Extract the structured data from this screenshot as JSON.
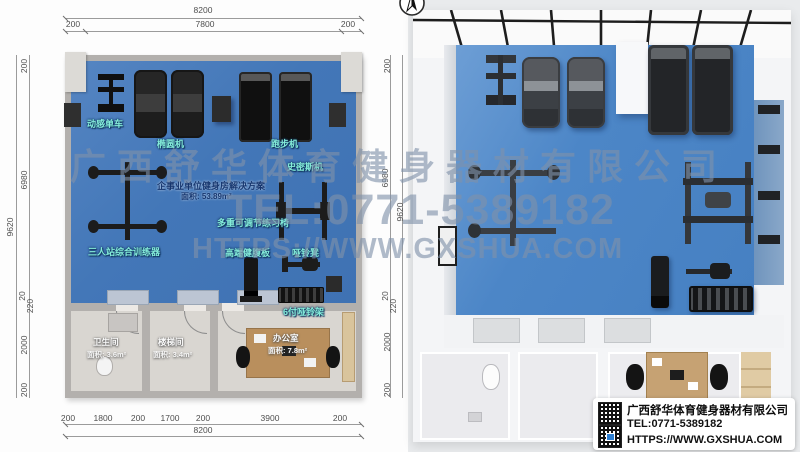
{
  "watermark": {
    "company": "广西舒华体育健身器材有限公司",
    "tel": "TEL:0771-5389182",
    "url": "HTTPS://WWW.GXSHUA.COM"
  },
  "plan": {
    "title": "企事业单位健身房解决方案",
    "area": "面积: 53.89m²",
    "dims": {
      "top_total": "8200",
      "top_row": [
        "200",
        "7800",
        "200"
      ],
      "left_total": "9620",
      "left_col": [
        "200",
        "6980",
        "20",
        "220",
        "2000",
        "200"
      ],
      "bottom_row": [
        "200",
        "1800",
        "200",
        "1700",
        "200",
        "3900",
        "200"
      ],
      "bottom_total": "8200"
    },
    "labels": {
      "spin_bike": "动感单车",
      "elliptical": "椭圆机",
      "treadmill": "跑步机",
      "smith": "史密斯机",
      "adjustable_bench": "多重可调节练习椅",
      "multi_trainer": "三人站综合训练器",
      "ab_board": "高端健腹板",
      "dumbbell_bench": "哑铃凳",
      "dumbbell_rack": "6付哑铃架"
    },
    "rooms": {
      "toilet": {
        "name": "卫生间",
        "area": "面积: 3.6m²"
      },
      "stairs": {
        "name": "楼梯间",
        "area": "面积: 3.4m²"
      },
      "office": {
        "name": "办公室",
        "area": "面积: 7.8m²"
      }
    }
  },
  "render": {
    "dims": {
      "total": "9620",
      "col": [
        "200",
        "6980",
        "20",
        "220",
        "2000",
        "200"
      ]
    }
  },
  "info_card": {
    "company": "广西舒华体育健身器材有限公司",
    "tel": "TEL:0771-5389182",
    "url": "HTTPS://WWW.GXSHUA.COM"
  },
  "colors": {
    "plan_floor": "#4377b8",
    "render_floor": "#4c86c7",
    "wall_gray": "#b3b0ad",
    "room_floor": "#d9d6d1",
    "label_teal": "#84ecd9",
    "title_navy": "#16366f",
    "watermark_gray_blue": "#8092a9"
  }
}
